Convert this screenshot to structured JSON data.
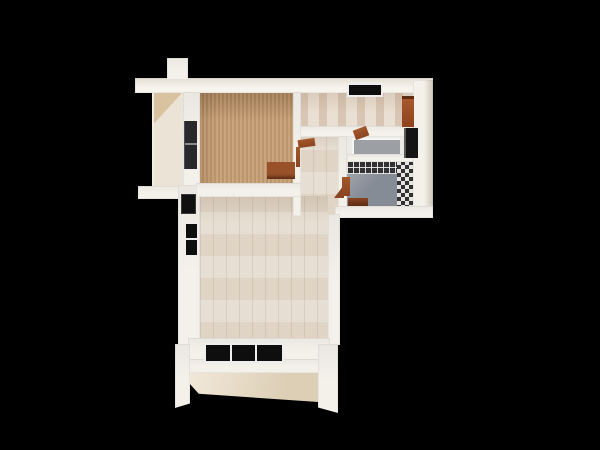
{
  "scene": {
    "description": "3D top-down render of a small apartment floor plan on a black background",
    "view": "top-down",
    "background": "#000000"
  },
  "palette": {
    "background": "#000000",
    "wall": "#f4f1eb",
    "carpet": "#c59d72",
    "wood": "#e4dbce",
    "tile": "#e9ddd0",
    "balcony": "#ebe3d6",
    "facade": "#ddcfb6",
    "bath_floor": "#868c96",
    "mosaic": "#323234",
    "furniture_wood": "#8a4522",
    "furniture_dark": "#29292b",
    "glass": "#0e0e0e",
    "frame": "#eeeeee"
  },
  "rooms": [
    {
      "id": "bedroom",
      "floor": "tan carpet"
    },
    {
      "id": "balcony-niche",
      "floor": "cream"
    },
    {
      "id": "kitchen",
      "floor": "beige tile"
    },
    {
      "id": "hallway",
      "floor": "light wood"
    },
    {
      "id": "living-room",
      "floor": "light wood planks"
    },
    {
      "id": "wc",
      "floor": "white with gray tray"
    },
    {
      "id": "bathroom",
      "floor": "slate gray, dark mosaic walls"
    }
  ],
  "objects": [
    {
      "id": "wardrobe",
      "room": "bedroom"
    },
    {
      "id": "desk",
      "room": "bedroom"
    },
    {
      "id": "kitchen-cabinet",
      "room": "kitchen"
    },
    {
      "id": "top-window",
      "room": "kitchen"
    },
    {
      "id": "side-window",
      "room": "living-room"
    },
    {
      "id": "bottom-window",
      "room": "living-room"
    },
    {
      "id": "entry-recess",
      "room": "living-room"
    },
    {
      "id": "wc-door",
      "room": "wc"
    },
    {
      "id": "bathroom-door",
      "room": "bathroom"
    }
  ]
}
